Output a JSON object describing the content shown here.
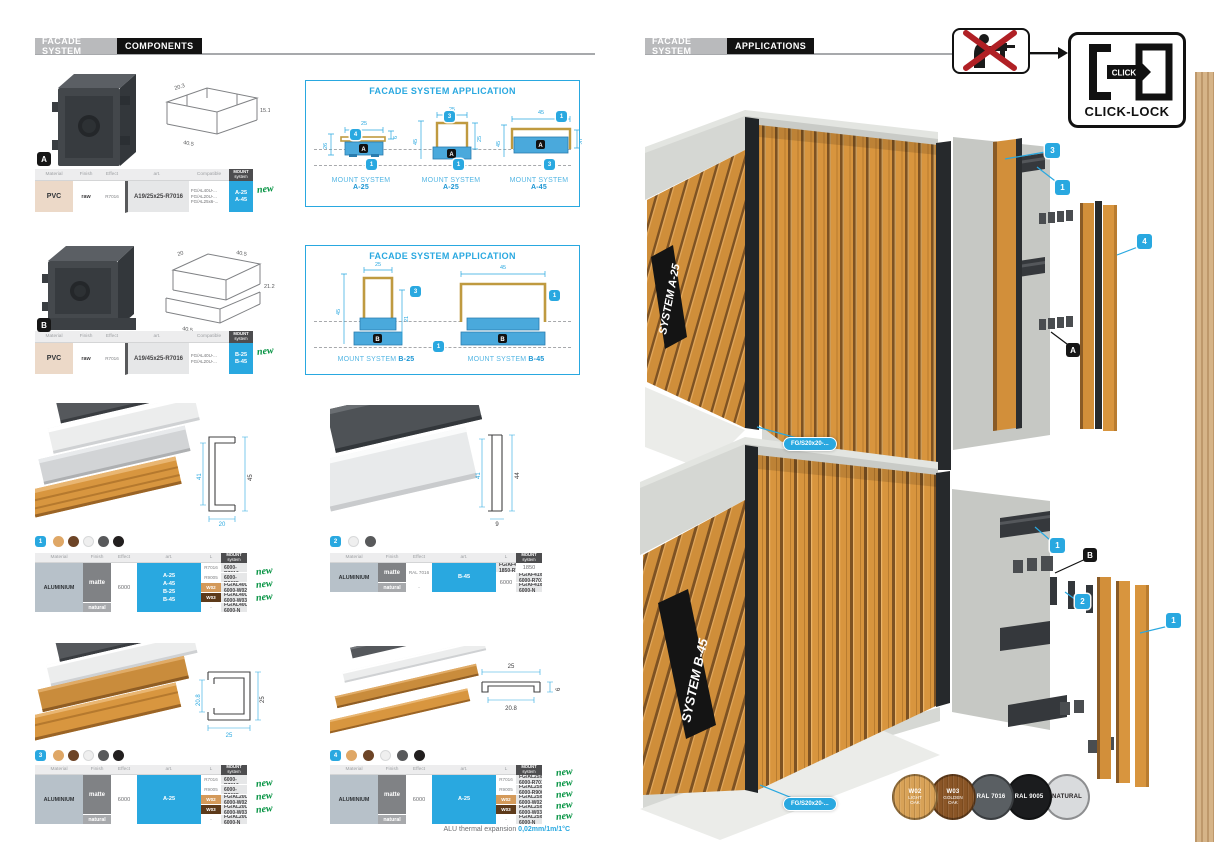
{
  "palette": {
    "accent": "#29a8e0",
    "new_green": "#00913f",
    "w02": "#d49a5a",
    "w03": "#5d3a1a",
    "wood": "#d8963f"
  },
  "left": {
    "brand": "FACADE SYSTEM",
    "section": "COMPONENTS",
    "headers": {
      "material": "Material",
      "finish": "Finish",
      "effect": "Effect",
      "art": "art.",
      "compatible": "Compatible",
      "length": "L",
      "mount1": "MOUNT",
      "mount2": "system"
    },
    "comp_a": {
      "id": "A",
      "d1": "20.3",
      "d2": "40.5",
      "d3": "15.1",
      "material": "PVC",
      "finish": "raw",
      "effect": "R7016",
      "art": "A19/25x25-R7016",
      "comp1": "FG/AL40U-...",
      "comp2": "FG/AL20U-...",
      "comp3": "FG/AL25x6-...",
      "m1": "A-25",
      "m2": "A-45",
      "new": "new"
    },
    "comp_b": {
      "id": "B",
      "d1": "20",
      "d2": "40.5",
      "d3": "21.2",
      "d4": "40.5",
      "material": "PVC",
      "finish": "raw",
      "effect": "R7016",
      "art": "A19/45x25-R7016",
      "comp1": "FG/AL40U-...",
      "comp2": "FG/AL20U-...",
      "m1": "B-25",
      "m2": "B-45",
      "new": "new"
    },
    "app_a": {
      "title": "FACADE SYSTEM APPLICATION",
      "d1": {
        "label": "MOUNT SYSTEM",
        "sys": "A-25",
        "top": "25",
        "left": "26",
        "right": "6",
        "bt": "4",
        "bb": "1",
        "clip": "A"
      },
      "d2": {
        "label": "MOUNT SYSTEM",
        "sys": "A-25",
        "top": "25",
        "left": "45",
        "right": "25",
        "bt": "3",
        "bb": "1",
        "clip": "A"
      },
      "d3": {
        "label": "MOUNT SYSTEM",
        "sys": "A-45",
        "top": "45",
        "left": "45",
        "right": "20",
        "bt": "1",
        "bb": "3",
        "clip": "A"
      }
    },
    "app_b": {
      "title": "FACADE SYSTEM APPLICATION",
      "shared": "1",
      "d1": {
        "label": "MOUNT SYSTEM",
        "sys": "B-25",
        "top": "25",
        "left": "45",
        "right": "21",
        "bt": "3",
        "clip": "B"
      },
      "d2": {
        "label": "MOUNT SYSTEM",
        "sys": "B-45",
        "top": "45",
        "bt": "1",
        "clip": "B"
      }
    },
    "p1": {
      "num": "1",
      "dl": "41",
      "dr": "45",
      "db": "20",
      "dots": [
        "#dfa766",
        "#6d4426",
        "#efefef",
        "#58595b",
        "#221f1f"
      ],
      "material": "ALUMINIUM",
      "finish_m": "matte",
      "finish_n": "natural",
      "length": "6000",
      "mounts": [
        "A-25",
        "A-45",
        "B-25",
        "B-45"
      ],
      "fx": [
        "R7016",
        "R9005",
        "W02",
        "W03",
        "-"
      ],
      "arts": [
        "FG/AL40U-6000-R7016",
        "FG/AL40U-6000-R9005",
        "FG/AL40U-6000-W02",
        "FG/AL40U-6000-W03",
        "FG/AL40U-6000-N"
      ],
      "news": [
        "new",
        "new",
        "new"
      ]
    },
    "p2": {
      "num": "2",
      "dl": "41",
      "dr": "44",
      "db": "9",
      "dots": [
        "#efefef",
        "#58595b"
      ],
      "material": "ALUMINIUM",
      "finish_m": "matte",
      "finish_n": "natural",
      "fx1": "RAL 7016",
      "fx3": "-",
      "len1": "1850",
      "len2": "6000",
      "mounts": [
        "B-45"
      ],
      "arts": [
        "FG/AF41x9-1850-R7016",
        "FG/AF41x9-6000-R7016",
        "FG/AF41x9-6000-N"
      ]
    },
    "p3": {
      "num": "3",
      "dl": "20.8",
      "dr": "25",
      "db": "25",
      "dots": [
        "#dfa766",
        "#6d4426",
        "#efefef",
        "#58595b",
        "#221f1f"
      ],
      "material": "ALUMINIUM",
      "finish_m": "matte",
      "finish_n": "natural",
      "length": "6000",
      "mounts": [
        "A-25"
      ],
      "fx": [
        "R7016",
        "R9005",
        "W02",
        "W03",
        "-"
      ],
      "arts": [
        "FG/AL20U-6000-R7016",
        "FG/AL20U-6000-R9005",
        "FG/AL20U-6000-W02",
        "FG/AL20U-6000-W03",
        "FG/AL20U-6000-N"
      ],
      "news": [
        "new",
        "new",
        "new"
      ]
    },
    "p4": {
      "num": "4",
      "dt": "25",
      "db": "20.8",
      "dr": "6",
      "dots": [
        "#dfa766",
        "#6d4426",
        "#efefef",
        "#58595b",
        "#221f1f"
      ],
      "material": "ALUMINIUM",
      "finish_m": "matte",
      "finish_n": "natural",
      "length": "6000",
      "mounts": [
        "A-25"
      ],
      "fx": [
        "R7016",
        "R9005",
        "W02",
        "W03",
        "-"
      ],
      "arts": [
        "FG/AL25x6-6000-R7016",
        "FG/AL25x6-6000-R9005",
        "FG/AL25x6-6000-W02",
        "FG/AL25x6-6000-W03",
        "FG/AL25x6-6000-N"
      ],
      "news": [
        "new",
        "new",
        "new",
        "new",
        "new"
      ]
    },
    "footnote": {
      "text": "ALU thermal expansion ",
      "value": "0,02mm/1m/1°C"
    }
  },
  "right": {
    "brand": "FACADE SYSTEM",
    "section": "APPLICATIONS",
    "click_lock": {
      "click": "CLICK",
      "label": "CLICK-LOCK"
    },
    "r1": {
      "system": "SYSTEM A-25",
      "part": "FG/S20x20-...",
      "b3": "3",
      "b1": "1",
      "b4": "4",
      "ba": "A"
    },
    "r2": {
      "system": "SYSTEM B-45",
      "part": "FG/S20x20-...",
      "b1a": "1",
      "bb": "B",
      "b2": "2",
      "b1b": "1"
    },
    "swatches": [
      {
        "code": "W02",
        "name1": "LIGHT",
        "name2": "OAK",
        "color": "#d8a257",
        "text": "#ffffff"
      },
      {
        "code": "W03",
        "name1": "GOLDEN",
        "name2": "OAK",
        "color": "#8a5526",
        "text": "#ffffff"
      },
      {
        "code": "RAL 7016",
        "name1": "",
        "name2": "",
        "color": "#5a5f63",
        "text": "#ffffff"
      },
      {
        "code": "RAL 9005",
        "name1": "",
        "name2": "",
        "color": "#1b1c1e",
        "text": "#ffffff"
      },
      {
        "code": "NATURAL",
        "name1": "",
        "name2": "",
        "color": "#d9dbdd",
        "text": "#231f20"
      }
    ]
  }
}
